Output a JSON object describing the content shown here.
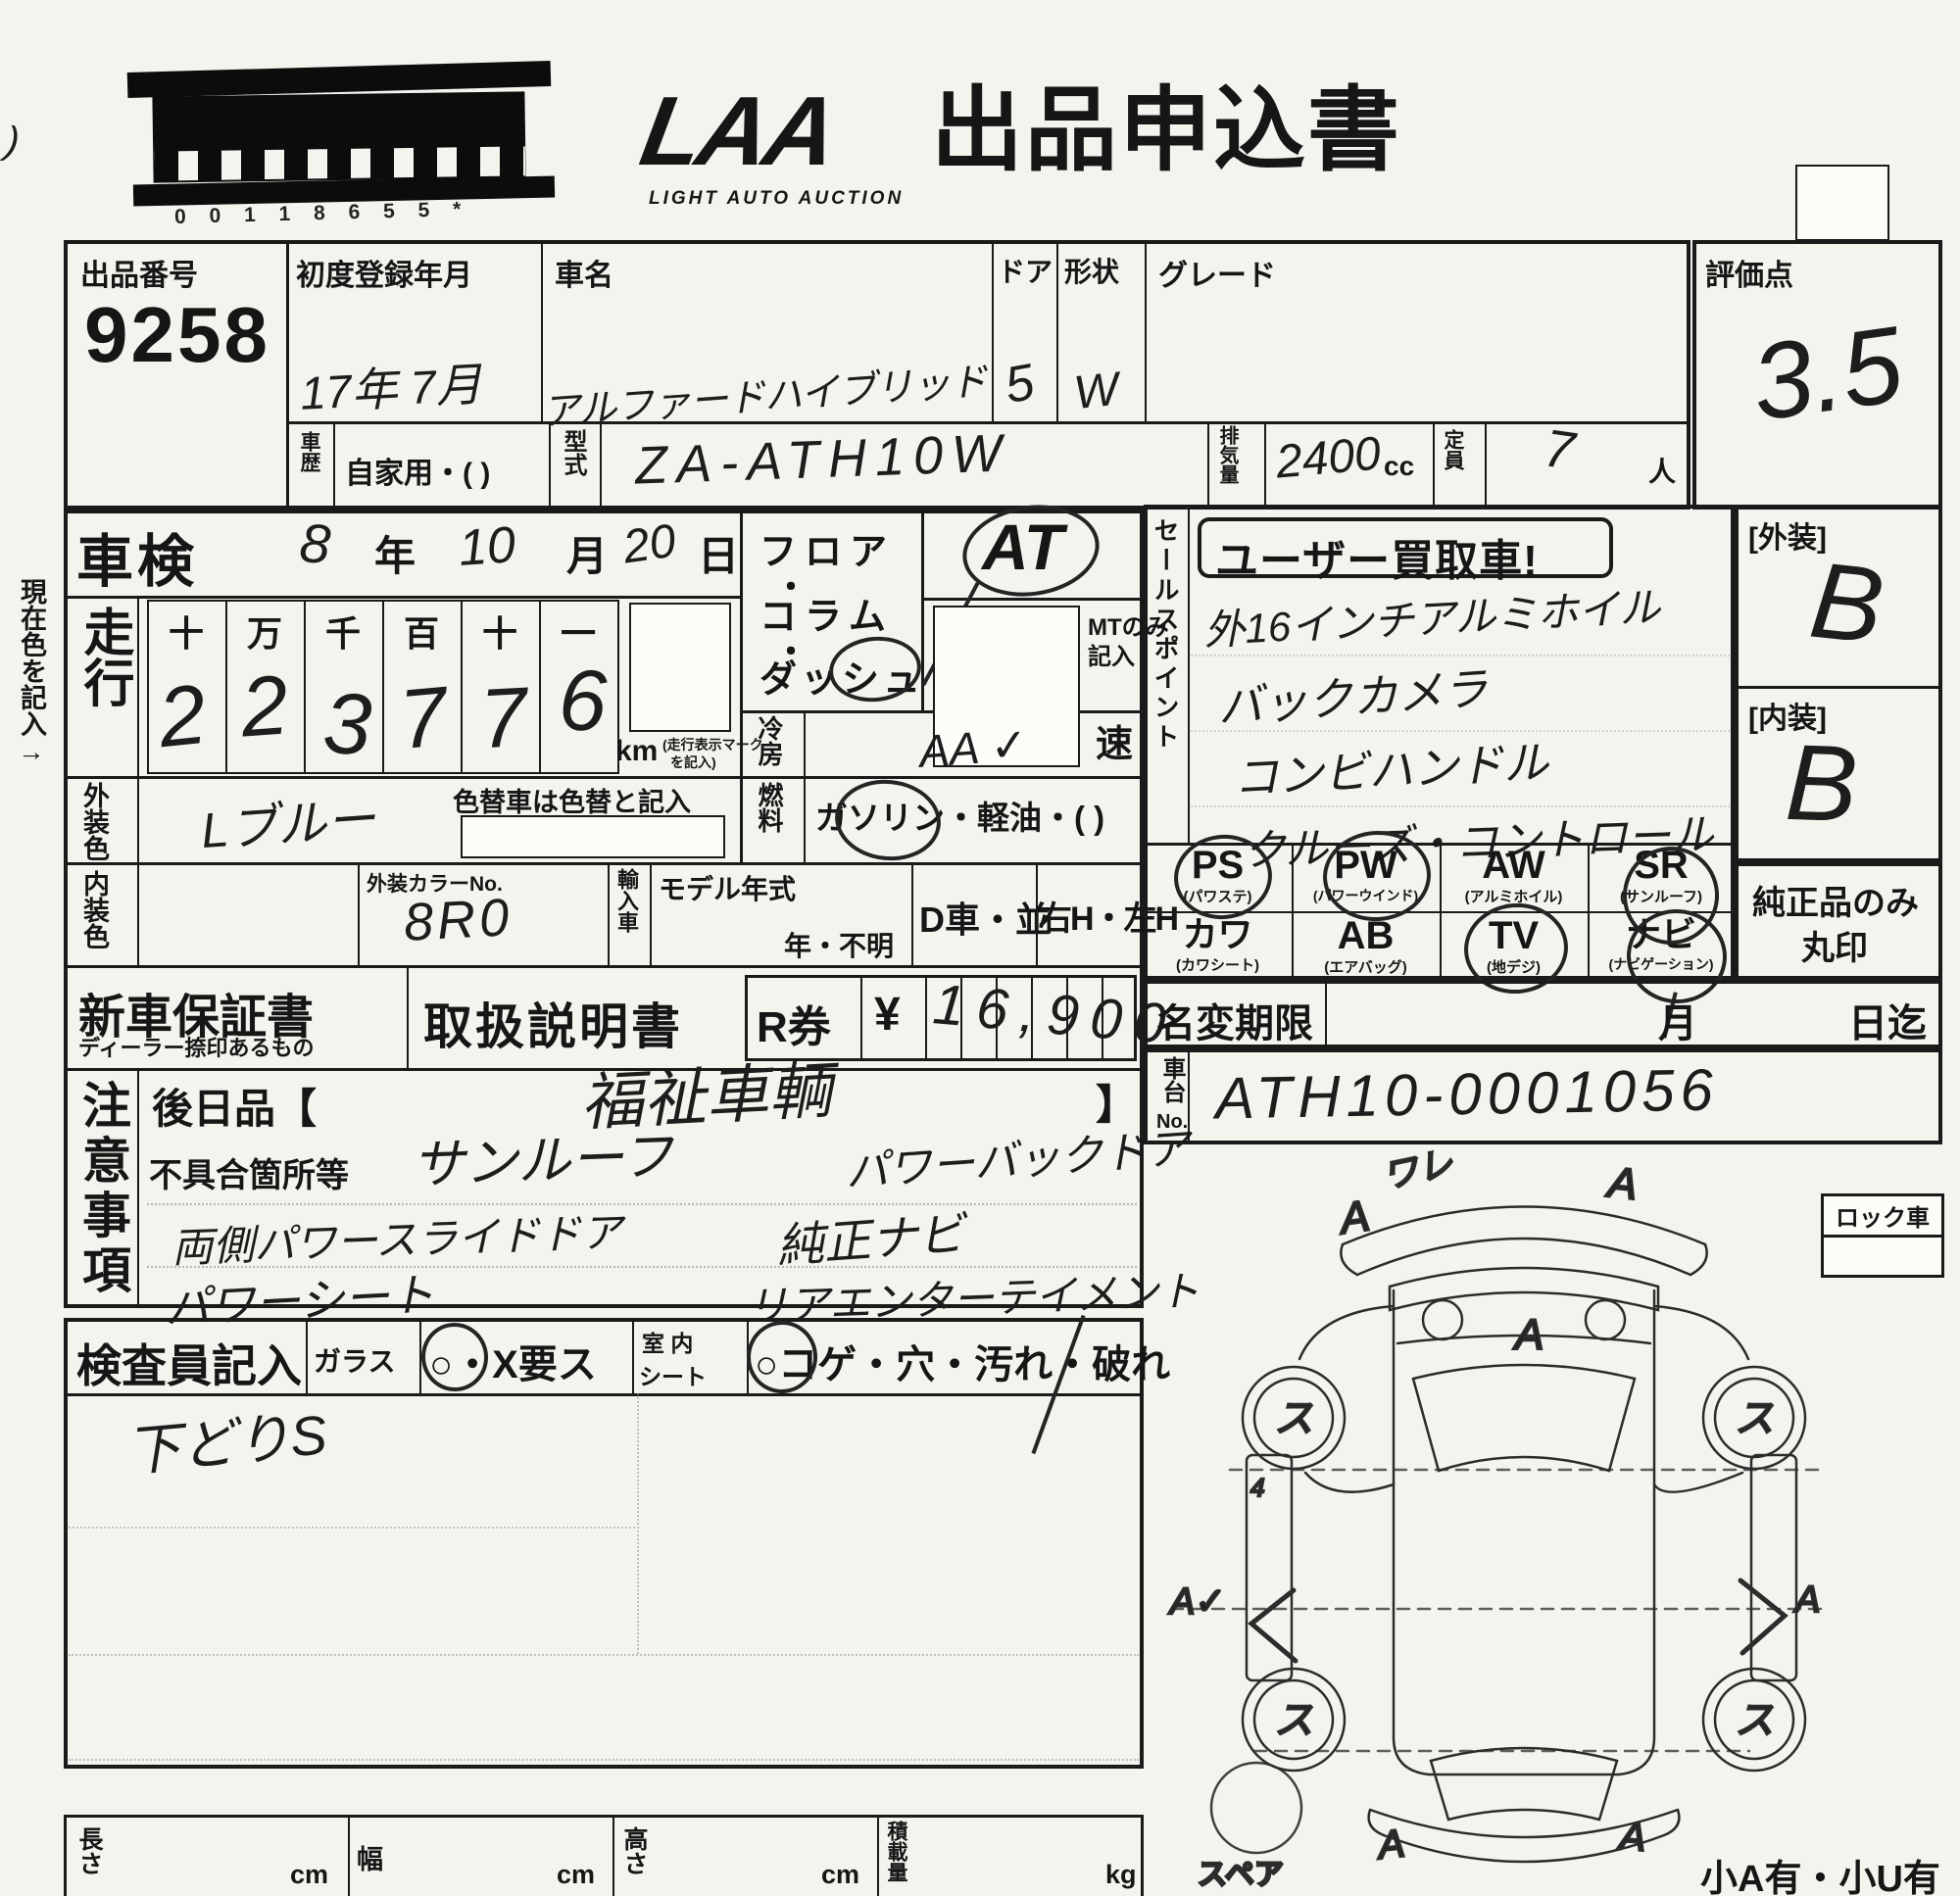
{
  "colors": {
    "ink": "#1a1a1a",
    "paper": "#f4f3ee"
  },
  "header": {
    "corner_mark": ")",
    "barcode_digits": "0 0 1 1 8 6 5 5 *",
    "logo_text": "LAA",
    "logo_subtext": "LIGHT AUTO AUCTION",
    "form_title": "出品申込書"
  },
  "top_row": {
    "lot_no_label": "出品番号",
    "lot_no": "9258",
    "first_reg_label": "初度登録年月",
    "first_reg": "17年 7月",
    "car_name_label": "車名",
    "car_name": "アルファードハイブリッド",
    "doors_label": "ドア",
    "doors": "5",
    "body_label": "形状",
    "body": "W",
    "grade_label": "グレード",
    "score_label": "評価点",
    "score": "3.5"
  },
  "reg_row": {
    "history_label": "車歴",
    "history": "自家用・(            )",
    "model_label": "型式",
    "model": "ZA-ATH10W",
    "disp_label": "排気量",
    "disp": "2400",
    "disp_unit": "cc",
    "seats_label": "定員",
    "seats": "7",
    "seats_unit": "人"
  },
  "shaken": {
    "label": "車検",
    "year": "8",
    "year_u": "年",
    "month": "10",
    "month_u": "月",
    "day": "20",
    "day_u": "日"
  },
  "mileage": {
    "label": "走行",
    "headers": [
      "十",
      "万",
      "千",
      "百",
      "十",
      "一"
    ],
    "digits": [
      "2",
      "2",
      "3",
      "7",
      "7",
      "6"
    ],
    "unit": "km",
    "unit_note_1": "(走行表示マーク",
    "unit_note_2": "を記入)"
  },
  "side_note": "現在色を記入→",
  "trans": {
    "line1": "フロア",
    "dot1": "・",
    "line2": "コラム",
    "dot2": "・",
    "line3": "ダッシュ",
    "at": "AT",
    "mt_note_1": "MTのみ",
    "mt_note_2": "記入",
    "speed": "速"
  },
  "aircon": {
    "label": "冷房",
    "value": "AA ✓"
  },
  "fuel": {
    "label": "燃料",
    "value": "ガソリン・軽油・(            )"
  },
  "ext_color": {
    "label": "外装色",
    "value": "Lブルー",
    "note": "色替車は色替と記入"
  },
  "int_row": {
    "label": "内装色",
    "color_no_label": "外装カラーNo.",
    "color_no": "8R0",
    "import_label": "輸入車",
    "my_label": "モデル年式",
    "my_value": "年・不明",
    "d_car": "D車・並",
    "handle": "右H・左H"
  },
  "docs": {
    "warranty": "新車保証書",
    "warranty_sub": "ディーラー捺印あるもの",
    "manual": "取扱説明書",
    "r_label": "R券",
    "yen": "¥",
    "price": "16,900"
  },
  "sales": {
    "side_label": "セールスポイント",
    "badge": "ユーザー買取車!",
    "lines": [
      "外16インチアルミホイル",
      "バックカメラ",
      "コンビハンドル",
      "クルーズ・コントロール"
    ]
  },
  "equip": {
    "items": [
      {
        "abbr": "PS",
        "name": "(パワステ)"
      },
      {
        "abbr": "PW",
        "name": "(パワーウインド)"
      },
      {
        "abbr": "AW",
        "name": "(アルミホイル)"
      },
      {
        "abbr": "SR",
        "name": "(サンルーフ)"
      },
      {
        "abbr": "カワ",
        "name": "(カワシート)"
      },
      {
        "abbr": "AB",
        "name": "(エアバッグ)"
      },
      {
        "abbr": "TV",
        "name": "(地デジ)"
      },
      {
        "abbr": "ナビ",
        "name": "(ナビゲーション)"
      }
    ],
    "genuine_1": "純正品のみ",
    "genuine_2": "丸印"
  },
  "ratings": {
    "ext_label": "[外装]",
    "ext": "B",
    "int_label": "[内装]",
    "int": "B"
  },
  "transfer": {
    "label": "名変期限",
    "month": "月",
    "until": "日迄"
  },
  "chassis": {
    "label_1": "車台",
    "label_2": "No.",
    "value": "ATH10-0001056"
  },
  "notes": {
    "side_label": "注意事項",
    "later_label": "後日品【",
    "later_value": "福祉車輌",
    "later_close": "】",
    "defect_label": "不具合箇所等",
    "left": [
      "サンルーフ",
      "両側パワースライドドア",
      "パワーシート"
    ],
    "right": [
      "パワーバックドア",
      "純正ナビ",
      "リアエンターテイメント"
    ]
  },
  "inspector": {
    "label": "検査員記入",
    "glass": "ガラス",
    "glass_opt": "○・X要ス",
    "seat_1": "室 内",
    "seat_2": "シート",
    "seat_opt": "○コゲ・穴・汚れ・破れ",
    "note": "下どりS"
  },
  "dims": {
    "len": "長さ",
    "wid": "幅",
    "hgt": "高さ",
    "load": "積載量",
    "cm": "cm",
    "kg": "kg"
  },
  "diagram": {
    "lock": "ロック車",
    "spare": "スペア",
    "corner": "小A有・小U有",
    "marks": {
      "front_left": "A",
      "front_top": "ワレ",
      "front_right": "A",
      "hood": "A",
      "wheel": "ス",
      "side_small": "4",
      "left": "A✓",
      "right": "A",
      "rear_left": "A",
      "rear_right": "A"
    }
  }
}
